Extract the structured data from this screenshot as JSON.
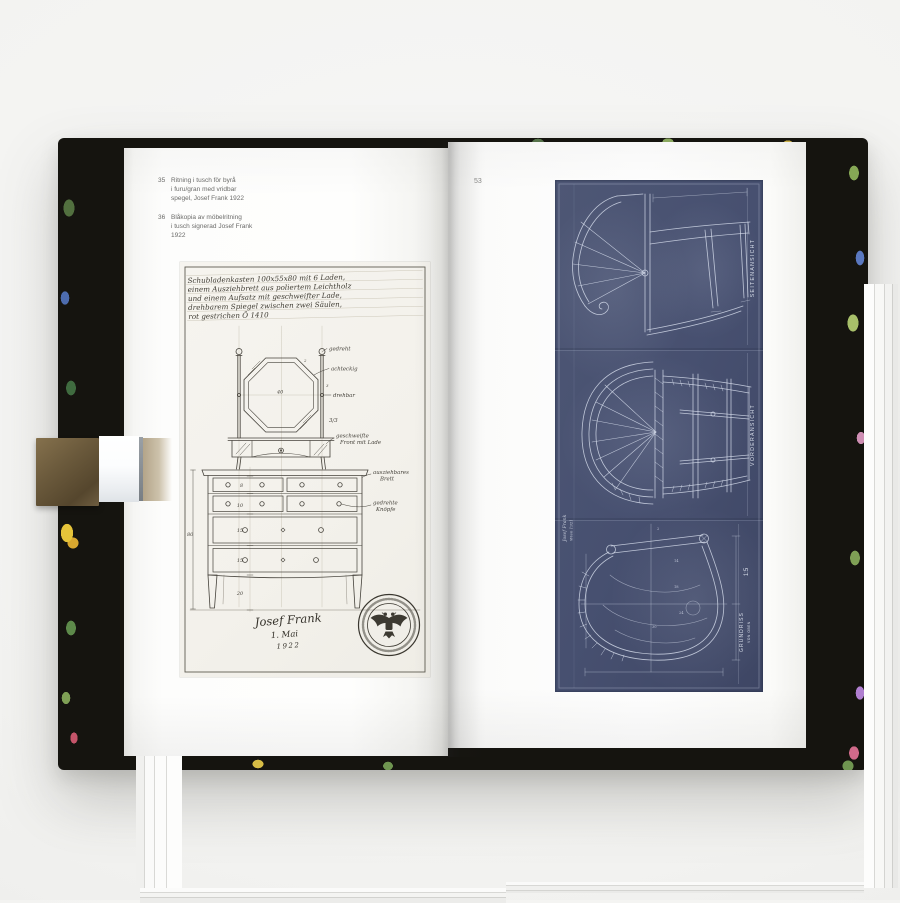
{
  "book": {
    "left_page": {
      "captions": [
        {
          "num": "35",
          "line1": "Ritning i tusch för byrå",
          "line2": "i furu/gran med vridbar",
          "line3": "spegel, Josef Frank 1922"
        },
        {
          "num": "36",
          "line1": "Blåkopia av möbelritning",
          "line2": "i tusch signerad Josef Frank",
          "line3": "1922"
        }
      ],
      "drawing": {
        "title_line1": "Schubladenkasten 100x55x80 mit 6 Laden,",
        "title_line2": "einem Ausziehbrett aus poliertem Leichtholz",
        "title_line3": "und einem Aufsatz mit geschweifter Lade,",
        "title_line4": "drehbarem Spiegel zwischen zwei Säulen,",
        "title_line5": "rot gestrichen   Ö 1410",
        "labels": {
          "gedreht": "gedreht",
          "achteckig": "achteckig",
          "drehbar": "drehbar",
          "ratio": "3/3",
          "geschweifte1": "geschweifte",
          "geschweifte2": "Front mit Lade",
          "ausziehbar1": "ausziehbares",
          "ausziehbar2": "Brett",
          "knoepfe1": "gedrehte",
          "knoepfe2": "Knöpfe"
        },
        "dims": {
          "mirror": "40",
          "height": "80",
          "d1": "8",
          "d2": "10",
          "d3": "15",
          "d4": "15",
          "d5": "20",
          "m2": "2",
          "m3": "3"
        },
        "signature_name": "Josef Frank",
        "signature_date1": "1. Mai",
        "signature_date2": "1922"
      }
    },
    "right_page": {
      "page_number": "53",
      "blueprint": {
        "label_side": "SEITENANSICHT",
        "label_front": "VORDERANSICHT",
        "label_plan": "GRUNDRISS",
        "label_plan_sub": "VON OBEN",
        "scale": "1:5",
        "dims": {
          "a": "2",
          "b": "14",
          "c": "18",
          "d": "24",
          "e": "30"
        },
        "signature1": "Josef Frank",
        "signature2": "Wien 1921"
      }
    }
  },
  "colors": {
    "blueprint_navy": "#4a5370",
    "cover_black": "#15140f",
    "ink": "#45423b",
    "clip_brass": "#6b5a3c"
  }
}
